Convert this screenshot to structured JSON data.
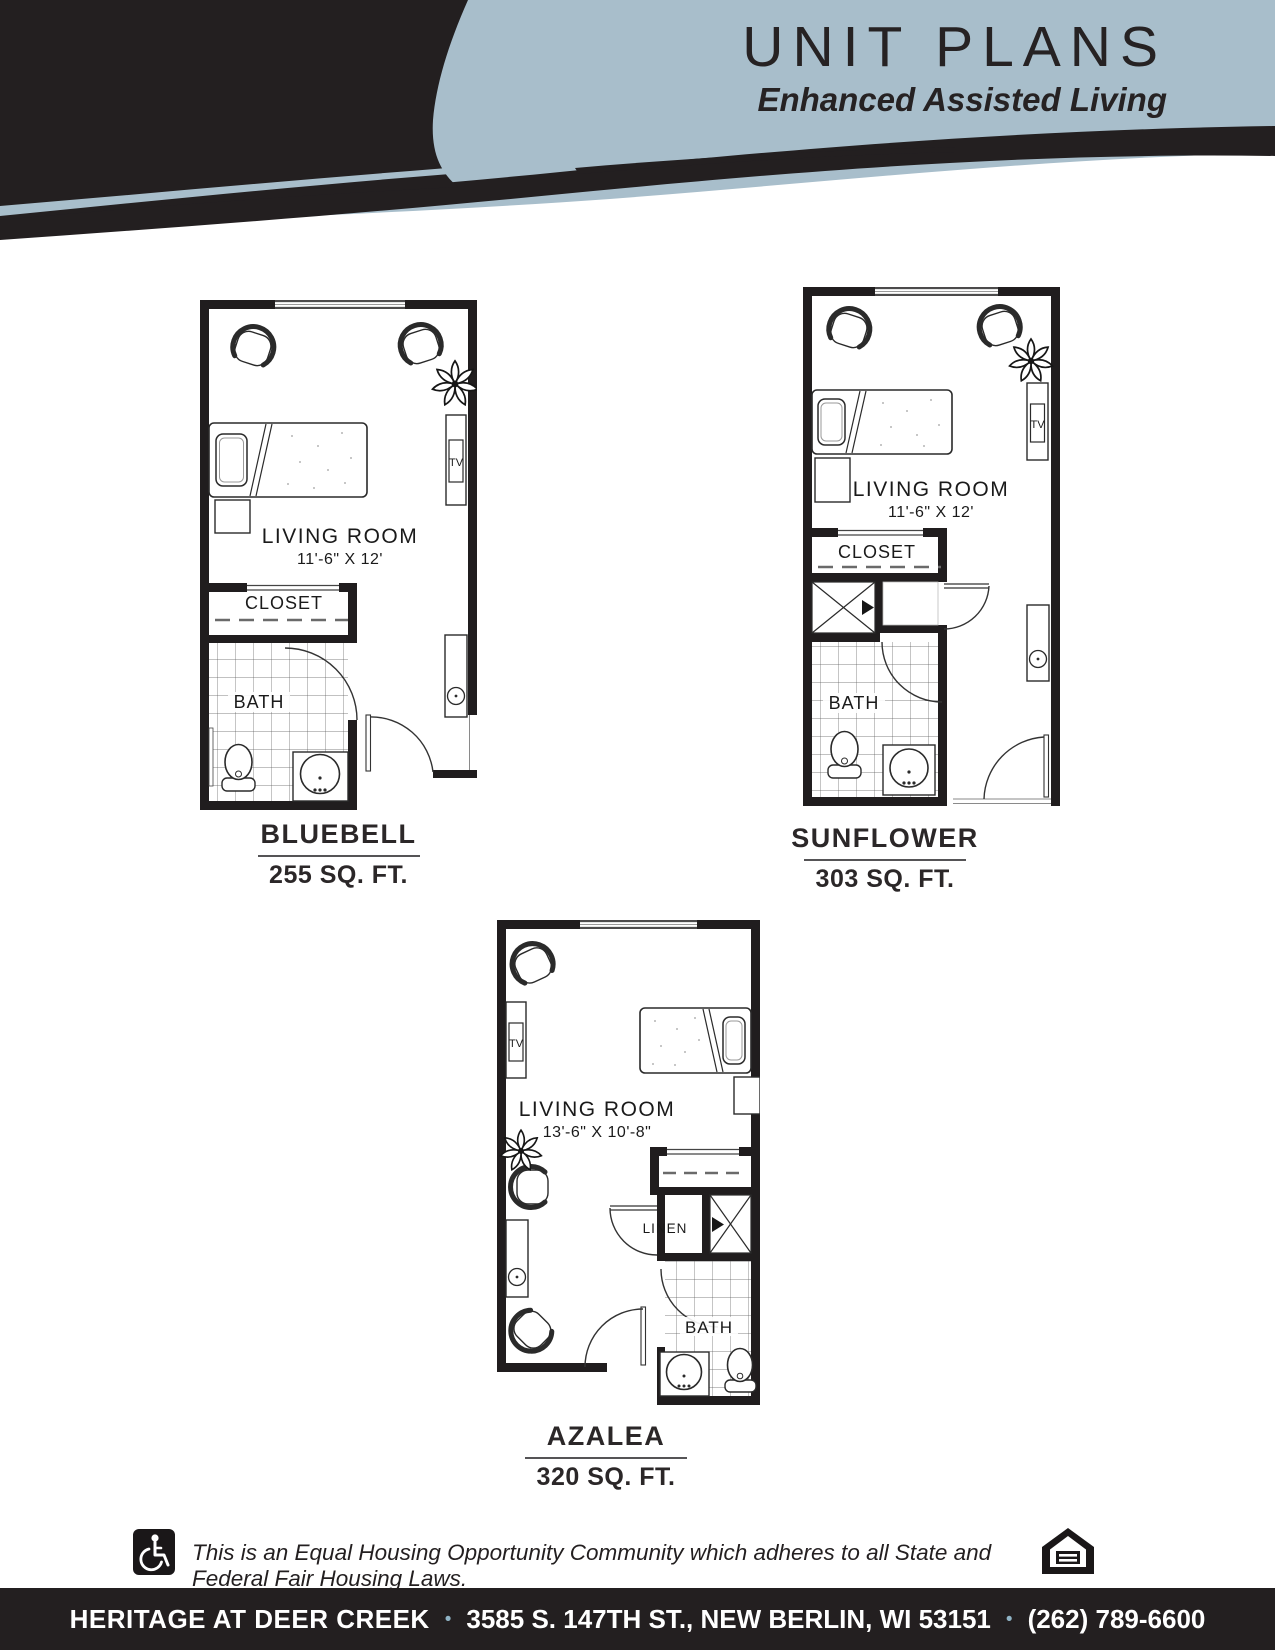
{
  "header": {
    "title": "UNIT PLANS",
    "subtitle": "Enhanced Assisted Living"
  },
  "units": {
    "bluebell": {
      "name": "BLUEBELL",
      "area": "255 SQ. FT.",
      "room_label": "LIVING ROOM",
      "room_dims": "11'-6\" X 12'",
      "closet_label": "CLOSET",
      "bath_label": "BATH",
      "tv_label": "TV"
    },
    "sunflower": {
      "name": "SUNFLOWER",
      "area": "303 SQ. FT.",
      "room_label": "LIVING ROOM",
      "room_dims": "11'-6\" X 12'",
      "closet_label": "CLOSET",
      "bath_label": "BATH",
      "tv_label": "TV"
    },
    "azalea": {
      "name": "AZALEA",
      "area": "320 SQ. FT.",
      "room_label": "LIVING ROOM",
      "room_dims": "13'-6\" X 10'-8\"",
      "linen_label": "LINEN",
      "bath_label": "BATH",
      "tv_label": "TV"
    }
  },
  "footer": {
    "fair_housing_text": "This is an Equal Housing Opportunity Community which adheres to all State and Federal Fair Housing Laws."
  },
  "address_bar": {
    "name": "HERITAGE AT DEER CREEK",
    "separator": "•",
    "address": "3585 S. 147TH ST., NEW BERLIN, WI 53151",
    "phone": "(262) 789-6600"
  },
  "icons": {
    "accessibility": "wheelchair-icon",
    "equal_housing": "house-equals-icon"
  },
  "colors": {
    "banner_blue": "#a8becb",
    "ink": "#231f20"
  }
}
